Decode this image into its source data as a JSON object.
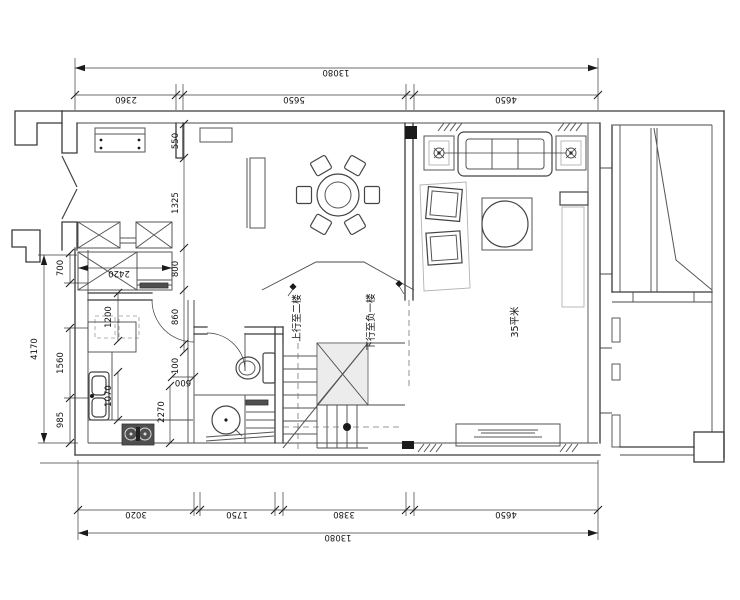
{
  "drawing": {
    "type": "residential floor plan (first floor)",
    "units": "mm"
  },
  "dims": {
    "top": {
      "overall": "13080",
      "seg1": "2360",
      "seg2": "5650",
      "seg3": "4650"
    },
    "bottom": {
      "overall": "13080",
      "seg1": "3020",
      "seg2": "1750",
      "seg3": "3380",
      "seg4": "4650"
    },
    "left": {
      "overall": "4170",
      "seg1": "700",
      "seg2": "1560",
      "seg3": "985"
    },
    "interior": {
      "d550": "550",
      "d1325": "1325",
      "d800": "800",
      "d860": "860",
      "d100": "100",
      "d600": "600",
      "d2270": "2270",
      "d1200": "1200",
      "d1070": "1070",
      "d2420": "2420"
    }
  },
  "labels": {
    "area": "35平米",
    "stairs_up": "上行至二楼",
    "stairs_down": "下行至负一楼"
  }
}
